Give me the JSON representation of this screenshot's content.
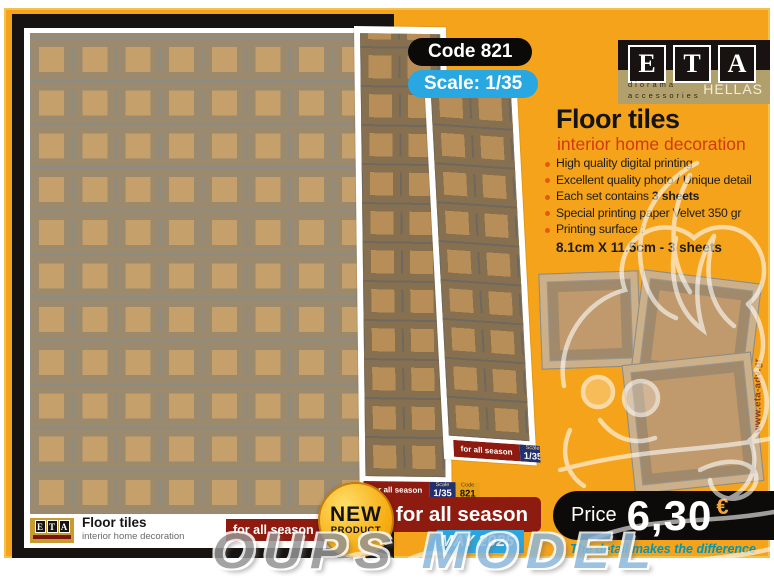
{
  "badges": {
    "code": "Code 821",
    "scale": "Scale: 1/35"
  },
  "brand": {
    "letters": [
      "E",
      "T",
      "A"
    ],
    "tagline1": "diorama",
    "tagline2": "accessories",
    "region": "HELLAS"
  },
  "product": {
    "title": "Floor tiles",
    "subtitle": "interior home decoration"
  },
  "features": [
    {
      "pre": "High quality digital printing",
      "bold": ""
    },
    {
      "pre": "Excellent quality photo / Unique detail",
      "bold": ""
    },
    {
      "pre": "Each set contains ",
      "bold": "3 sheets"
    },
    {
      "pre": "Special printing paper Velvet 350 gr",
      "bold": ""
    },
    {
      "pre": "Printing surface :",
      "bold": ""
    }
  ],
  "surface_size": "8.1cm X 11.5cm - 3 sheets",
  "sheet_label": {
    "season": "for all season",
    "scale_caption": "Scale",
    "scale_value": "1/35",
    "code_caption": "Code",
    "code_value": "821"
  },
  "sheet_footer": {
    "title": "Floor tiles",
    "subtitle": "interior home decoration"
  },
  "promo": {
    "new_top": "NEW",
    "new_bottom": "PRODUCT",
    "season_banner": "for all season",
    "date": "MAY 2025"
  },
  "price": {
    "label": "Price",
    "value": "6,30",
    "currency": "€",
    "slogan": "The detail makes the difference"
  },
  "watermark": {
    "part1": "OUPS",
    "part2": "MODEL"
  },
  "website": "www.eta-adv.gr"
}
